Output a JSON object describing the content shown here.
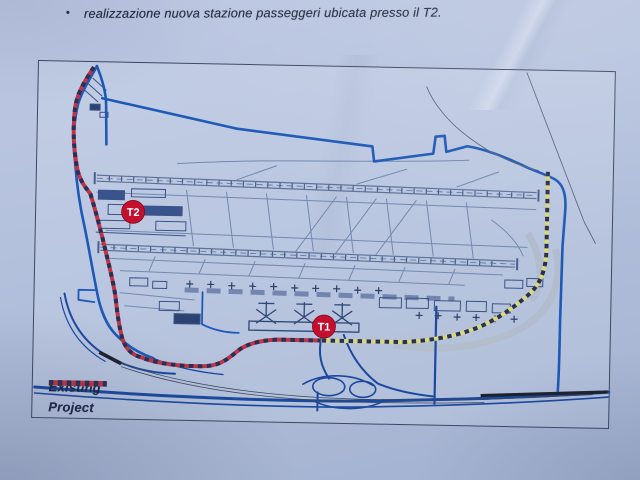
{
  "document": {
    "bullet_glyph": "•",
    "bullet_text": "realizzazione nuova stazione passeggeri ubicata presso il T2."
  },
  "map": {
    "marker_t2_label": "T2",
    "marker_t1_label": "T1",
    "legend": {
      "existing_label": "Existing",
      "project_label": "Project"
    },
    "colors": {
      "existing_line": "#d8d97b",
      "project_line": "#bf3448",
      "legend_dash": "#2a3053",
      "marker_red": "#c50f2e",
      "boundary_blue": "#1d59b6",
      "road_blue": "#1b49a0",
      "detail_line": "#7389ae",
      "building_line": "#3a5288",
      "rail_black": "#1d2230"
    }
  }
}
